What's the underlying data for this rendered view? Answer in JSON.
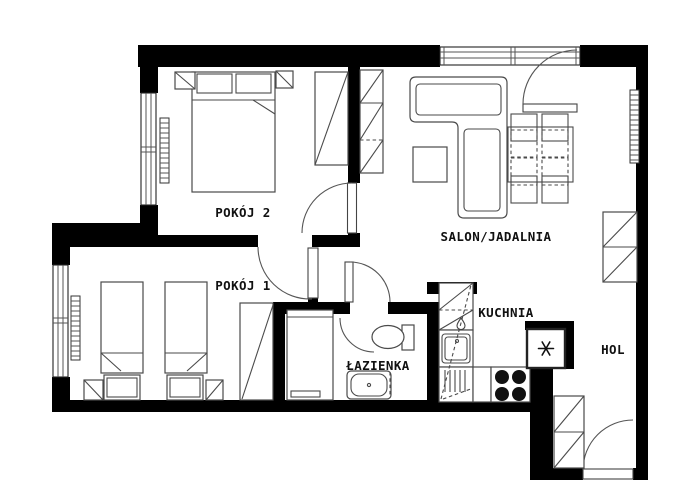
{
  "page": {
    "type": "apartment-floor-plan",
    "background": "#ffffff"
  },
  "rooms": [
    {
      "id": "pokoj-2",
      "label": "POKÓJ 2"
    },
    {
      "id": "pokoj-1",
      "label": "POKÓJ 1"
    },
    {
      "id": "salon-jadalnia",
      "label": "SALON/JADALNIA"
    },
    {
      "id": "lazienka",
      "label": "ŁAZIENKA"
    },
    {
      "id": "kuchnia",
      "label": "KUCHNIA"
    },
    {
      "id": "hol",
      "label": "HOL"
    }
  ],
  "icons": [
    {
      "name": "snowflake-fridge-icon",
      "meaning": "refrigerator"
    },
    {
      "name": "droplet-icon",
      "meaning": "water point / heater"
    }
  ],
  "colors": {
    "walls": "#000000",
    "background": "#ffffff",
    "furniture_outline": "#4a4a4a",
    "label_text": "#111111"
  }
}
